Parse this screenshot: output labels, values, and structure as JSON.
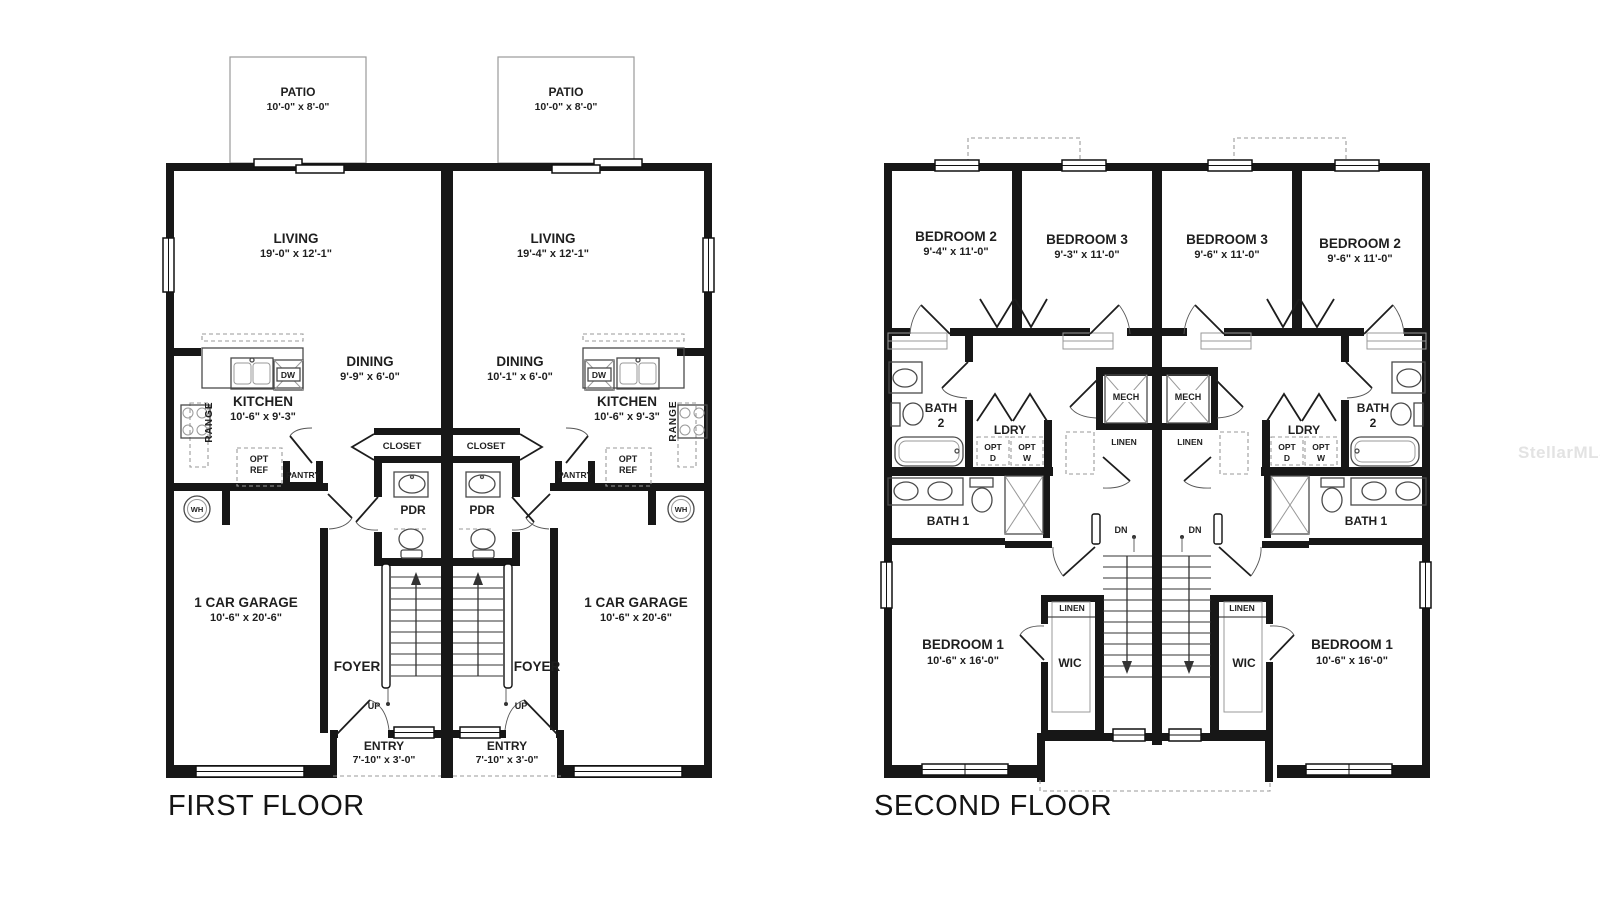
{
  "watermark": "StellarMLS",
  "first_floor": {
    "title": "FIRST FLOOR",
    "left": {
      "patio": {
        "name": "PATIO",
        "dims": "10'-0\" x 8'-0\""
      },
      "living": {
        "name": "LIVING",
        "dims": "19'-0\" x 12'-1\""
      },
      "dining": {
        "name": "DINING",
        "dims": "9'-9\" x 6'-0\""
      },
      "kitchen": {
        "name": "KITCHEN",
        "dims": "10'-6\" x 9'-3\""
      },
      "range": "RANGE",
      "dw": "DW",
      "opt_ref": {
        "l1": "OPT",
        "l2": "REF"
      },
      "pantry": "PANTRY",
      "closet": "CLOSET",
      "pdr": "PDR",
      "wh": "WH",
      "garage": {
        "name": "1 CAR GARAGE",
        "dims": "10'-6\" x 20'-6\""
      },
      "foyer": "FOYER",
      "up": "UP",
      "entry": {
        "name": "ENTRY",
        "dims": "7'-10\" x 3'-0\""
      }
    },
    "right": {
      "patio": {
        "name": "PATIO",
        "dims": "10'-0\" x 8'-0\""
      },
      "living": {
        "name": "LIVING",
        "dims": "19'-4\" x 12'-1\""
      },
      "dining": {
        "name": "DINING",
        "dims": "10'-1\" x 6'-0\""
      },
      "kitchen": {
        "name": "KITCHEN",
        "dims": "10'-6\" x 9'-3\""
      },
      "range": "RANGE",
      "dw": "DW",
      "opt_ref": {
        "l1": "OPT",
        "l2": "REF"
      },
      "pantry": "PANTRY",
      "closet": "CLOSET",
      "pdr": "PDR",
      "wh": "WH",
      "garage": {
        "name": "1 CAR GARAGE",
        "dims": "10'-6\" x 20'-6\""
      },
      "foyer": "FOYER",
      "up": "UP",
      "entry": {
        "name": "ENTRY",
        "dims": "7'-10\" x 3'-0\""
      }
    }
  },
  "second_floor": {
    "title": "SECOND FLOOR",
    "left": {
      "bedroom2": {
        "name": "BEDROOM 2",
        "dims": "9'-4\" x 11'-0\""
      },
      "bedroom3": {
        "name": "BEDROOM 3",
        "dims": "9'-3\" x 11'-0\""
      },
      "bath2": {
        "l1": "BATH",
        "l2": "2"
      },
      "ldry": "LDRY",
      "opt_d": {
        "l1": "OPT",
        "l2": "D"
      },
      "opt_w": {
        "l1": "OPT",
        "l2": "W"
      },
      "mech": "MECH",
      "linen": "LINEN",
      "bath1": "BATH 1",
      "dn": "DN",
      "linen2": "LINEN",
      "wic": "WIC",
      "bedroom1": {
        "name": "BEDROOM 1",
        "dims": "10'-6\" x 16'-0\""
      }
    },
    "right": {
      "bedroom3": {
        "name": "BEDROOM 3",
        "dims": "9'-6\" x 11'-0\""
      },
      "bedroom2": {
        "name": "BEDROOM 2",
        "dims": "9'-6\" x 11'-0\""
      },
      "bath2": {
        "l1": "BATH",
        "l2": "2"
      },
      "ldry": "LDRY",
      "opt_d": {
        "l1": "OPT",
        "l2": "D"
      },
      "opt_w": {
        "l1": "OPT",
        "l2": "W"
      },
      "mech": "MECH",
      "linen": "LINEN",
      "bath1": "BATH 1",
      "dn": "DN",
      "linen2": "LINEN",
      "wic": "WIC",
      "bedroom1": {
        "name": "BEDROOM 1",
        "dims": "10'-6\" x 16'-0\""
      }
    }
  }
}
